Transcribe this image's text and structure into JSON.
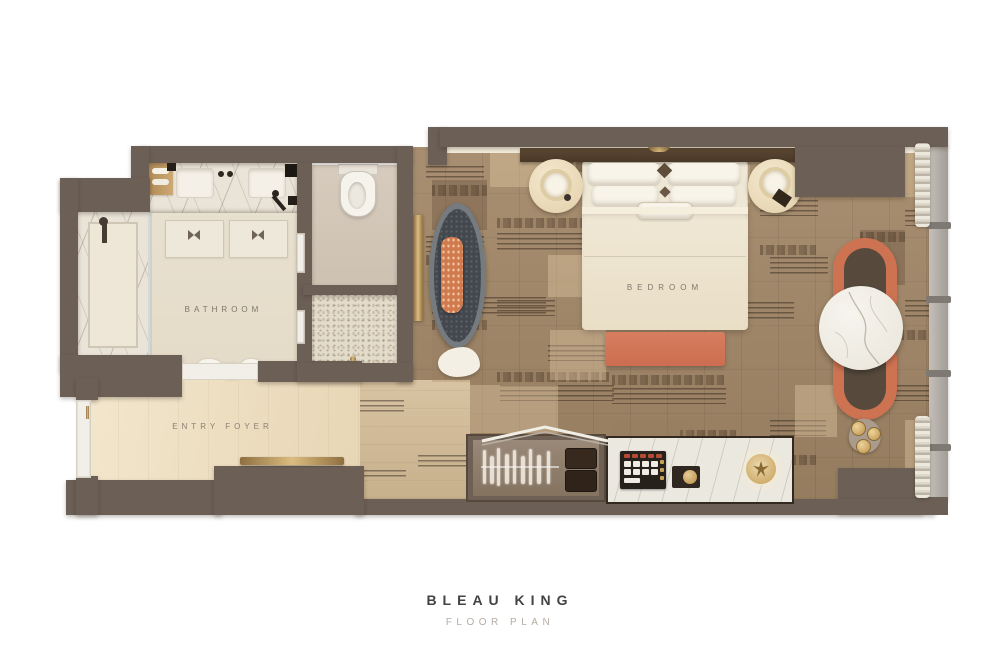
{
  "caption": {
    "title": "BLEAU KING",
    "subtitle": "FLOOR PLAN"
  },
  "rooms": {
    "bathroom": {
      "label": "BATHROOM"
    },
    "entry_foyer": {
      "label": "ENTRY FOYER"
    },
    "bedroom": {
      "label": "BEDROOM"
    }
  },
  "features": {
    "bathroom": [
      "double-vanity",
      "sink-left",
      "sink-right",
      "faucets",
      "bath-mats",
      "walk-in-shower",
      "shower-handset",
      "glass-partition",
      "towels",
      "toilet",
      "water-closet",
      "closet",
      "pocket-doors",
      "amenity-tray"
    ],
    "entry_foyer": [
      "entry-door",
      "gold-bench"
    ],
    "bedroom": [
      "king-bed",
      "pillows",
      "headboard",
      "accent-pillow",
      "nightstand-left",
      "nightstand-right",
      "table-lamps",
      "foot-bench",
      "chaise-lounge",
      "bolster-pillow",
      "cloud-pouf",
      "floor-mirror",
      "lounge-chair-pair",
      "round-marble-table",
      "flower-side-table",
      "bar-niche",
      "glassware",
      "serving-trays",
      "luggage-rack",
      "minibar-console",
      "minibar-tray",
      "accessory-box",
      "gold-table-lamp",
      "structural-column",
      "window-wall",
      "curtain-top",
      "curtain-bottom"
    ]
  },
  "colors": {
    "wall": "#6c5f56",
    "wood_floor": "#a1886a",
    "light_floor": "#efe3c9",
    "marble": "#ece8df",
    "accent_orange": "#d0745a",
    "chaise": "#43484e",
    "gold": "#c59e5d",
    "title_text": "#454240",
    "subtitle_text": "#b5ada3",
    "room_label_text": "#7e776b"
  }
}
